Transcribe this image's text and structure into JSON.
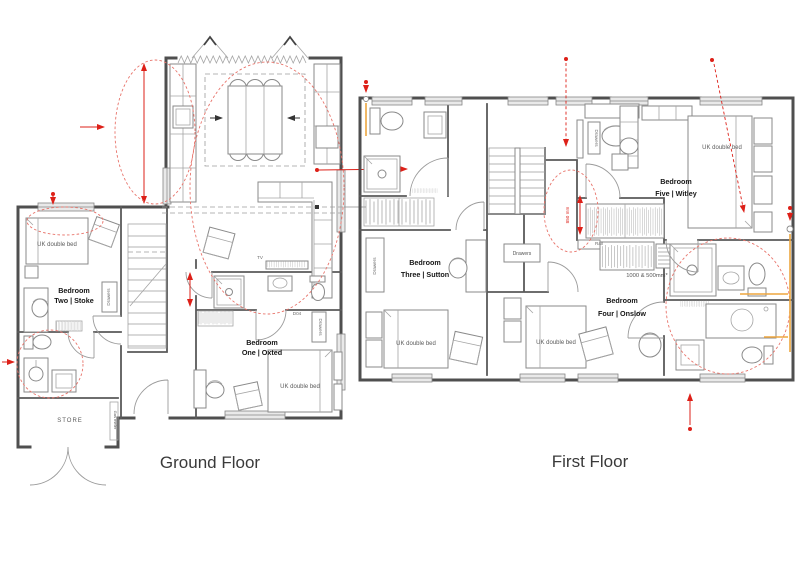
{
  "titles": {
    "ground": "Ground Floor",
    "first": "First Floor"
  },
  "ground_floor": {
    "bedroom_two": {
      "name_line1": "Bedroom",
      "name_line2": "Two | Stoke",
      "bed_label": "UK double bed",
      "drawers_label": "Drawers"
    },
    "bedroom_one": {
      "name_line1": "Bedroom",
      "name_line2": "One | Oxted",
      "bed_label": "UK double bed",
      "drawers_label": "Drawers",
      "door_tag": "D04"
    },
    "store_label": "STORE",
    "gas_meter_label": "Gas meter",
    "tv_label": "TV"
  },
  "first_floor": {
    "bedroom_three": {
      "name_line1": "Bedroom",
      "name_line2": "Three | Sutton",
      "bed_label": "UK double bed",
      "drawers_label": "Drawers"
    },
    "bedroom_four": {
      "name_line1": "Bedroom",
      "name_line2": "Four | Onslow",
      "bed_label": "UK double bed",
      "drawers_label": "Drawers"
    },
    "bedroom_five": {
      "name_line1": "Bedroom",
      "name_line2": "Five | Witley",
      "bed_label": "UK double bed"
    },
    "landing_drawers_label": "Drawers",
    "rail_label": "Rail",
    "wardrobe_dimension_label": "1000 & 500mm*",
    "door_width_label": "850 mm"
  },
  "colors": {
    "annotation_red": "#dd2018",
    "dashed_red": "#e8736a",
    "pipe_orange": "#eda63f",
    "wall": "#4f4f4f"
  }
}
